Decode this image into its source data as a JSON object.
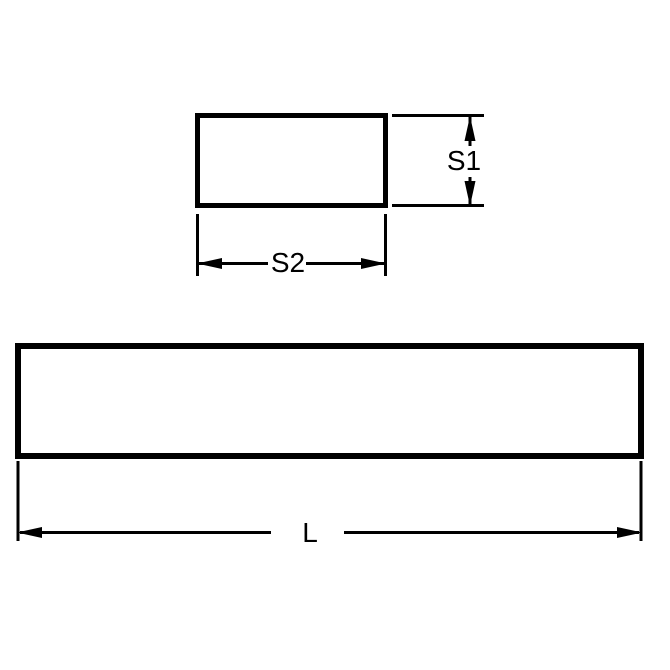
{
  "diagram": {
    "labels": {
      "s1": "S1",
      "s2": "S2",
      "l": "L"
    },
    "colors": {
      "line": "#000000",
      "text": "#000000",
      "background": "#ffffff"
    }
  }
}
